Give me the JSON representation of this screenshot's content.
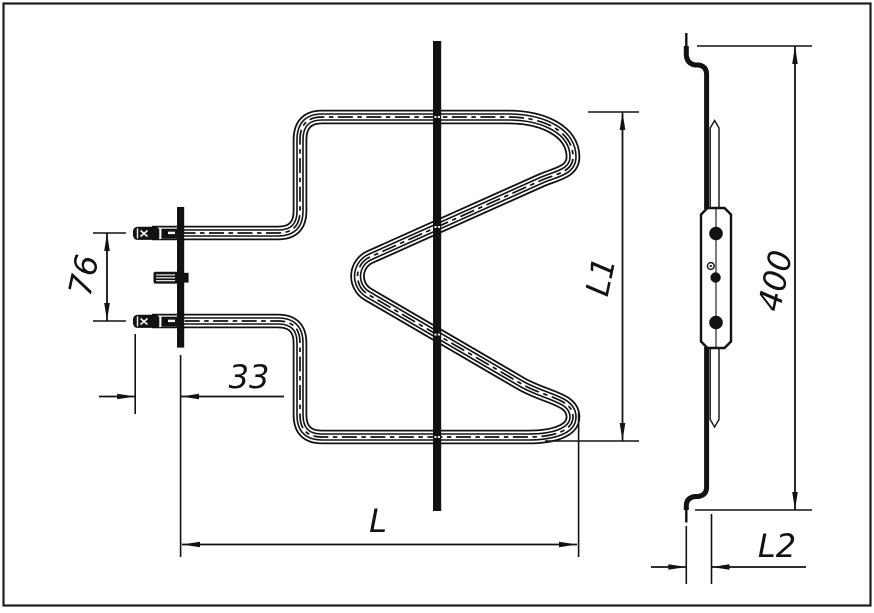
{
  "canvas": {
    "background": "#ffffff",
    "frame_color": "#1e1e1e",
    "line_color": "#121212"
  },
  "front_view": {
    "dim_terminal_pitch": "76",
    "dim_terminal_to_bracket": "33",
    "dim_width": "L",
    "dim_height": "L1"
  },
  "side_view": {
    "dim_length": "400",
    "dim_hook_offset": "L2"
  }
}
